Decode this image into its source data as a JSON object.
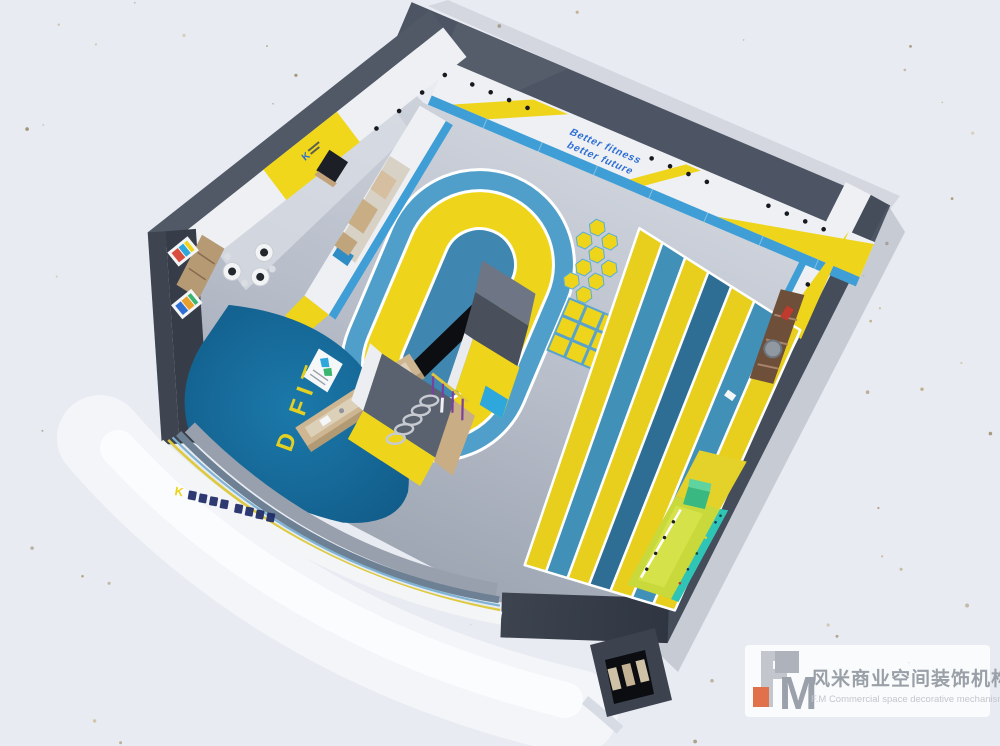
{
  "scene": {
    "slogan": {
      "line1": "Better  fitness",
      "line2": "better  future"
    },
    "entrance_floor_text": "D FIT",
    "brand_logo": "K"
  },
  "watermark": {
    "monogram": "M",
    "company_cn": "风米商业空间装饰机构",
    "company_en": "F.M Commercial space decorative mechanism"
  },
  "palette": {
    "background": "#e8ebf2",
    "wall_dark": "#4d5564",
    "wall_white": "#eef0f3",
    "accent_yellow": "#eed51b",
    "wainscot_blue": "#3f9ed6",
    "track_blue": "#4f9fca",
    "track_inner_blue": "#3f86b0",
    "entrance_blue": "#176a99",
    "mat_green": "#c9d83b",
    "climb_teal": "#2ec4b6",
    "equipment_purple": "#7b3fa0",
    "wood": "#c2a37c",
    "watermark_orange": "#e0714a",
    "slogan_blue": "#2e6ed3"
  }
}
